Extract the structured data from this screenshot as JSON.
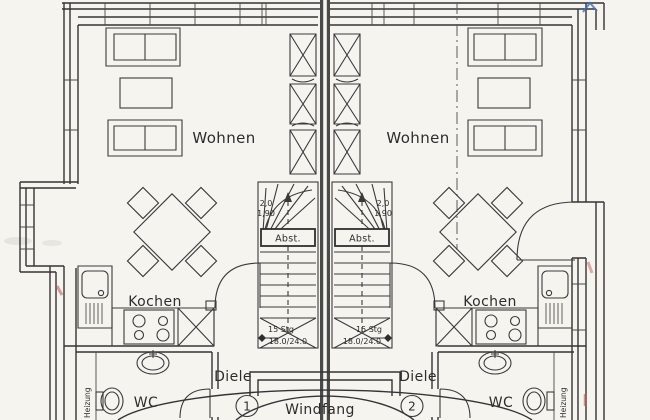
{
  "colors": {
    "paper": "#f5f4ef",
    "ink": "#3a3a3a",
    "party_wall": "#4a4a4a",
    "red_mark": "#c0534d",
    "blue_mark": "#3f6fc0"
  },
  "rooms": {
    "left": {
      "unit_number": "1",
      "living": "Wohnen",
      "kitchen": "Kochen",
      "hall": "Diele",
      "wc": "WC",
      "heating": "Heizung"
    },
    "right": {
      "unit_number": "2",
      "living": "Wohnen",
      "kitchen": "Kochen",
      "hall": "Diele",
      "wc": "WC",
      "heating": "Heizung"
    }
  },
  "vestibule": {
    "label": "Windfang"
  },
  "stairs": {
    "left": {
      "storage": "Abst.",
      "steps": "15 Stg",
      "rise_run": "18.0/24.0",
      "headroom_a": "2,0",
      "headroom_b": "1,90"
    },
    "right": {
      "storage": "Abst.",
      "steps": "15 Stg",
      "rise_run": "18.0/24.0",
      "headroom_a": "2,0",
      "headroom_b": "1,90"
    }
  }
}
